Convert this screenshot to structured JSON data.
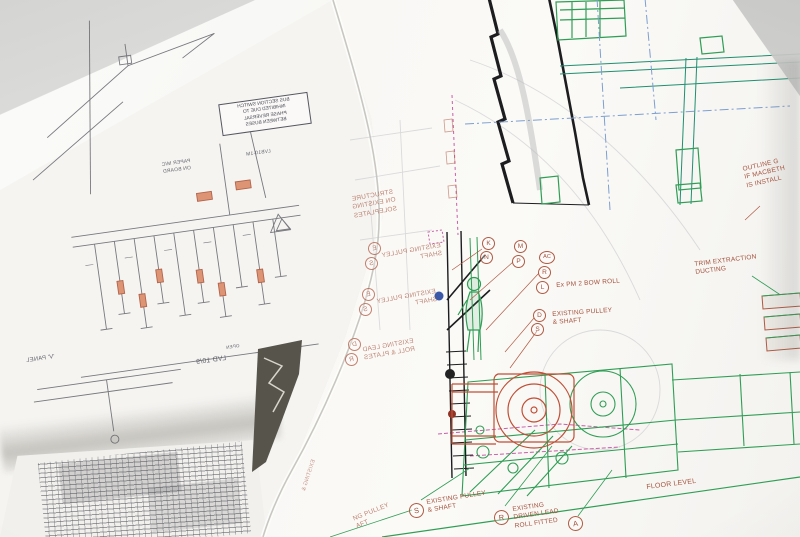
{
  "photo": {
    "colors": {
      "label_red": "#a4523c",
      "machinery_green": "#2f9e55",
      "elevation_teal": "#1f8f70",
      "gearbox_orange": "#bf4f35",
      "centerline_blue": "#7d9fd0",
      "match_magenta": "#c75fa6",
      "linework_black": "#1d1d1f",
      "schematic_gray": "#5c5c64",
      "paper_white": "#f6f5f2",
      "backdrop_gray": "#d6d6d4"
    }
  },
  "main_sheet": {
    "note_top_right": {
      "l1": "OUTLINE G",
      "l2": "IF MACBETH",
      "l3": "IS INSTALL"
    },
    "trim_extraction": {
      "l1": "TRIM EXTRACTION",
      "l2": "DUCTING"
    },
    "callouts": {
      "k": "K",
      "n": "N",
      "m": "M",
      "p": "P",
      "ac": "AC",
      "r": "R",
      "l": "L",
      "d": "D",
      "s": "S"
    },
    "bow_roll": "Ex PM 2 BOW ROLL",
    "pulley_shaft": {
      "l1": "EXISTING PULLEY",
      "l2": "& SHAFT"
    },
    "floor": "FLOOR LEVEL",
    "bottom": {
      "s": "S",
      "s_l1": "EXISTING PULLEY",
      "s_l2": "& SHAFT",
      "r": "R",
      "r_l1": "EXISTING",
      "r_l2": "DRIVEN LEAD",
      "r_l3": "ROLL FITTED",
      "a": "A",
      "frag_l1": "NG PULLEY",
      "frag_l2": "AFT"
    },
    "mirrored": {
      "structure": {
        "l1": "STRUCTURE",
        "l2": "ON EXISTING",
        "l3": "SOLEPLATES"
      },
      "pulley_a": {
        "c1": "E",
        "c2": "S",
        "l1": "EXISTING PULLEY",
        "l2": "SHAFT"
      },
      "pulley_b": {
        "c1": "E",
        "c2": "S",
        "l1": "EXISTING PULLEY",
        "l2": "SHAFT"
      },
      "lead": {
        "c1": "D",
        "c2": "R",
        "l1": "EXISTING LEAD",
        "l2": "ROLL & PLATES"
      },
      "existing_small": "EXISTING &"
    }
  },
  "left_sheet": {
    "warning_box": {
      "l1": "BUS SECTION SWITCH",
      "l2": "INHIBITED DUE TO",
      "l3": "PHASE REVERSAL",
      "l4": "BETWEEN BUSES"
    },
    "bus_label": "LVB10-1M",
    "board_label": {
      "l1": "PAPER M/C",
      "l2": "ON BOARD"
    },
    "feeder_label": "LVD 10/9",
    "open_label": "OPEN",
    "panel_label": "'V' PANEL"
  }
}
